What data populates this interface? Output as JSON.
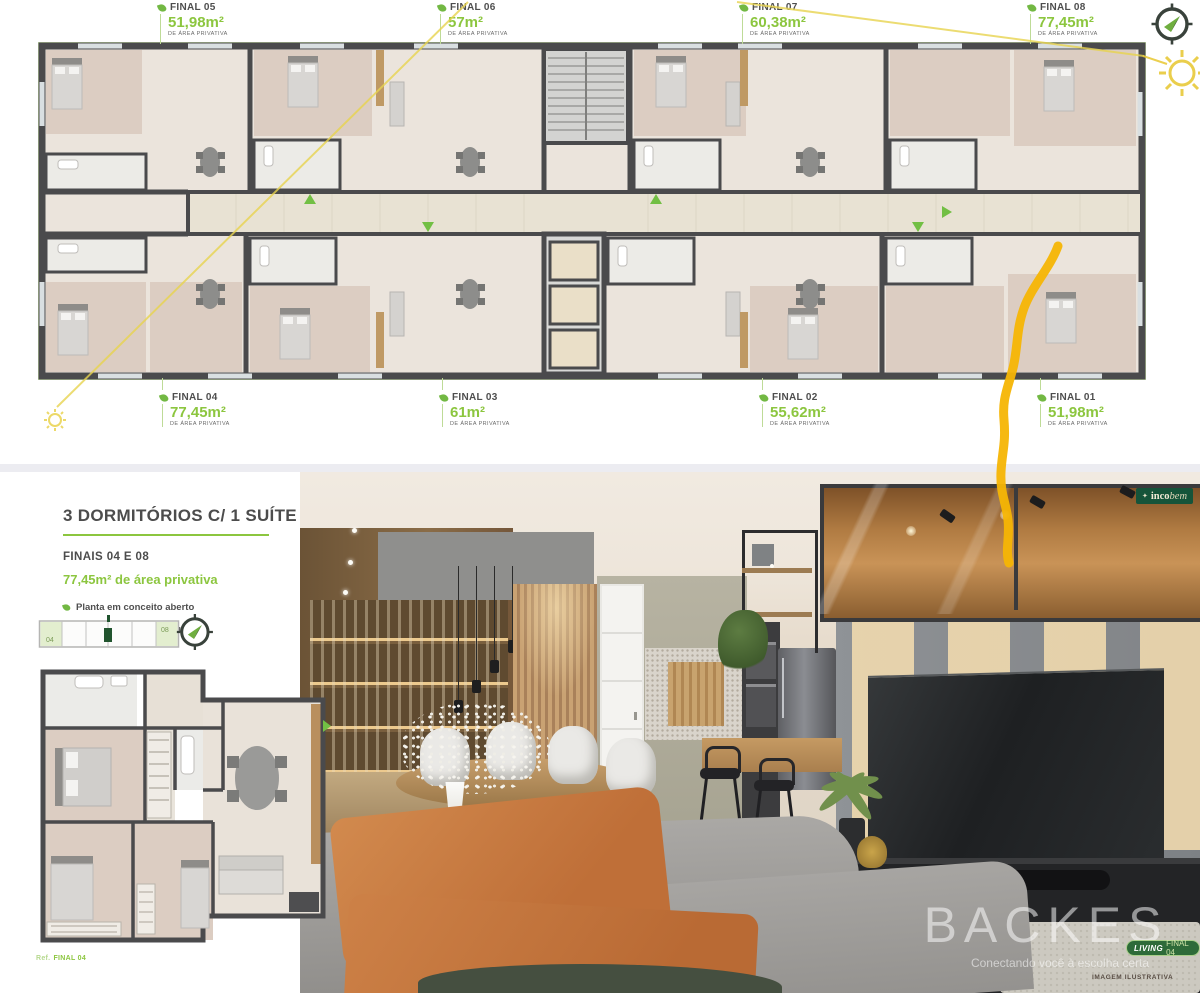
{
  "overview": {
    "area_caption": "DE ÁREA PRIVATIVA",
    "top_units": [
      {
        "name": "FINAL 05",
        "area": "51,98m²"
      },
      {
        "name": "FINAL 06",
        "area": "57m²"
      },
      {
        "name": "FINAL 07",
        "area": "60,38m²"
      },
      {
        "name": "FINAL 08",
        "area": "77,45m²"
      }
    ],
    "bottom_units": [
      {
        "name": "FINAL 04",
        "area": "77,45m²"
      },
      {
        "name": "FINAL 03",
        "area": "61m²"
      },
      {
        "name": "FINAL 02",
        "area": "55,62m²"
      },
      {
        "name": "FINAL 01",
        "area": "51,98m²"
      }
    ]
  },
  "panel": {
    "title": "3 DORMITÓRIOS C/ 1 SUÍTE",
    "subtitle": "FINAIS 04 E 08",
    "area_line": "77,45m² de área privativa",
    "features": [
      {
        "label": "Planta em conceito aberto"
      },
      {
        "label": "Cozinha com churrasqueira"
      }
    ],
    "locator": {
      "left": "04",
      "right": "08"
    },
    "ref_prefix": "Ref.",
    "ref_value": "FINAL 04"
  },
  "render": {
    "brand_icon": "✦",
    "brand_bold": "inco",
    "brand_italic": "bem",
    "watermark": "BACKES",
    "tagline": "Conectando você à escolha certa",
    "living_label": "LIVING",
    "living_unit": "FINAL 04",
    "disclaimer": "IMAGEM ILUSTRATIVA"
  },
  "colors": {
    "accent_green": "#8cc63f",
    "leaf_green": "#72b843",
    "badge_dark_green": "#15543a",
    "annotation_yellow": "#f6b504",
    "wall_gray": "#4a4a4c",
    "floor_beige": "#ebe4dc",
    "wood_room": "#dccdc2",
    "sofa_orange": "#c87c42"
  }
}
